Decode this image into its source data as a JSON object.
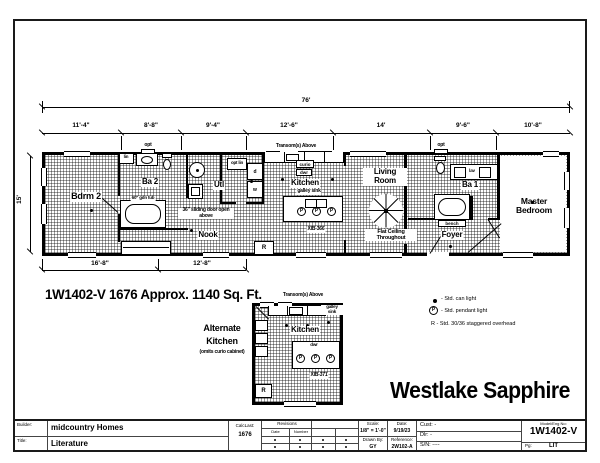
{
  "colors": {
    "ink": "#000000",
    "paper": "#ffffff"
  },
  "plan": {
    "name": "Westlake Sapphire",
    "spec_line": "1W1402-V 1676 Approx. 1140 Sq. Ft.",
    "overall": "76'",
    "depth": "15'",
    "top_dims": [
      "11'-4\"",
      "8'-8\"",
      "9'-4\"",
      "12'-6\"",
      "14'",
      "9'-6\"",
      "10'-8\""
    ],
    "bottom_dims": [
      "16'-8\"",
      "12'-8\""
    ],
    "transom": "Transom(s) Above",
    "opt": "opt",
    "opt_lin": "opt lin",
    "lin": "lin",
    "bdrm2": "Bdrm 2",
    "ba2": "Ba 2",
    "gdn_tub": "60\" gdn tub",
    "utl": "Utl",
    "washer": "w",
    "dryer": "d",
    "nook": "Nook",
    "sliding": "36\" sliding door open above",
    "kitchen": "Kitchen",
    "galley_sink": "galley sink",
    "curio": "curio",
    "dwr": "dwr",
    "island": "XIB-366",
    "living": "Living Room",
    "flat": "Flat Ceiling Throughout",
    "r_mark": "R",
    "ba1": "Ba 1",
    "lav": "lav",
    "bench": "bench",
    "foyer": "Foyer",
    "master": "Master Bedroom"
  },
  "alt": {
    "heading": "Alternate Kitchen",
    "sub": "(omits curio cabinet)",
    "transom": "Transom(s) Above",
    "kitchen": "Kitchen",
    "galley_sink": "galley sink",
    "dwr": "dwr",
    "island": "XIB-371",
    "r_mark": "R"
  },
  "legend": {
    "p": "P",
    "can": "- Std. can light",
    "pendant": "- Std. pendant light",
    "overhead": "R - Std. 30/36 staggered overhead"
  },
  "titleblock": {
    "builder_label": "Builder:",
    "builder": "midcountry Homes",
    "title_label": "Title:",
    "title": "Literature",
    "calclast_label": "CalcLast:",
    "calclast": "1676",
    "revisions": "Revisions",
    "rev_date": "Date",
    "rev_number": "Number",
    "scale_label": "Scale:",
    "scale": "1/8\" = 1'-0\"",
    "drawnby_label": "Drawn By:",
    "drawnby": "GY",
    "date_label": "Date:",
    "date": "9/19/23",
    "reference_label": "Reference:",
    "reference": "2W102-A",
    "cust_label": "Cust:",
    "cust": "-",
    "dlr_label": "Dlr:",
    "dlr": "-",
    "sn_label": "S/N:",
    "sn": "----",
    "model_label": "Model/Eng No:",
    "model": "1W1402-V",
    "pg_label": "Pg:",
    "pg": "LIT"
  }
}
